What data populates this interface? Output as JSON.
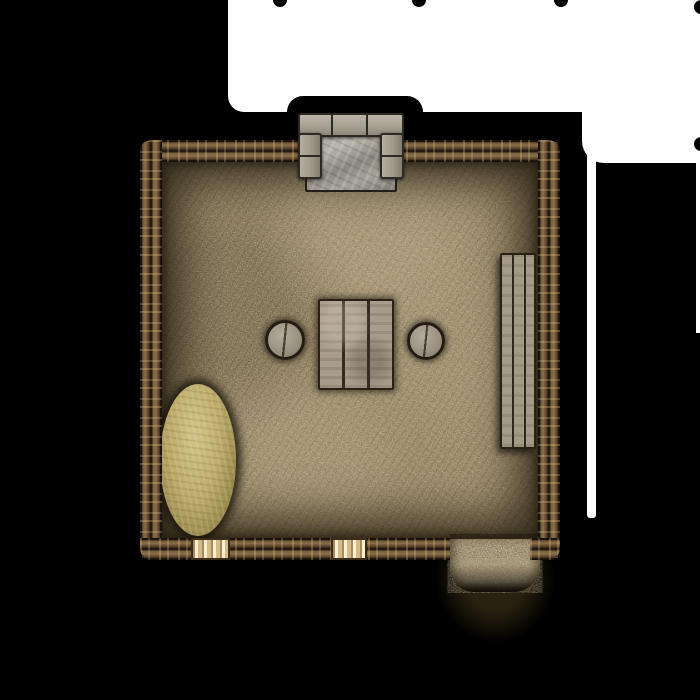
{
  "canvas": {
    "width": 700,
    "height": 700,
    "outside_background": "#000000",
    "page_background": "#ffffff"
  },
  "palette": {
    "floor_dirt": "#a08e6a",
    "wall_wood_dark": "#4f3b26",
    "wall_wood_light": "#8b6f4a",
    "stone_block": "#a49e91",
    "hearth_stone": "#9b978e",
    "furniture_wood": "#a89d8c",
    "bench_wood": "#a39a88",
    "hay": "#bcab6b",
    "window_wood": "#d8c197",
    "shadow": "#000000"
  },
  "room": {
    "label": "Single-room cottage, top-down battle map",
    "bounds": [
      140,
      140,
      420,
      420
    ],
    "doorway": {
      "side": "south",
      "span": [
        450,
        530
      ]
    },
    "windows": [
      {
        "label": "South window west",
        "bounds": [
          191,
          538,
          39,
          22
        ]
      },
      {
        "label": "South window east",
        "bounds": [
          331,
          538,
          36,
          22
        ]
      }
    ]
  },
  "objects": {
    "fireplace": {
      "label": "Stone fireplace on north wall",
      "bounds": [
        298,
        96,
        106,
        96
      ]
    },
    "table": {
      "label": "Wooden plank table",
      "bounds": [
        318,
        299,
        76,
        91
      ]
    },
    "stool_left": {
      "label": "Round stool west of table",
      "bounds": [
        265,
        320,
        40,
        40
      ]
    },
    "stool_right": {
      "label": "Round stool east of table",
      "bounds": [
        407,
        322,
        38,
        38
      ]
    },
    "bench": {
      "label": "Wooden bench along east wall",
      "bounds": [
        500,
        253,
        36,
        196
      ]
    },
    "hay_pile": {
      "label": "Hay bed against west wall",
      "bounds": [
        160,
        384,
        76,
        152
      ]
    },
    "door_path": {
      "label": "Dirt path through south doorway",
      "bounds": [
        450,
        534,
        90,
        58
      ]
    }
  },
  "background_shapes": {
    "white_regions": [
      [
        228,
        0,
        472,
        112
      ],
      [
        582,
        0,
        118,
        163
      ],
      [
        587,
        100,
        9,
        418
      ],
      [
        696,
        100,
        4,
        233
      ]
    ],
    "chimney_shadow": [
      287,
      96,
      136,
      54
    ],
    "grid_dots": [
      [
        280,
        1
      ],
      [
        419,
        1
      ],
      [
        561,
        1
      ],
      [
        701,
        7
      ],
      [
        701,
        144
      ]
    ]
  }
}
